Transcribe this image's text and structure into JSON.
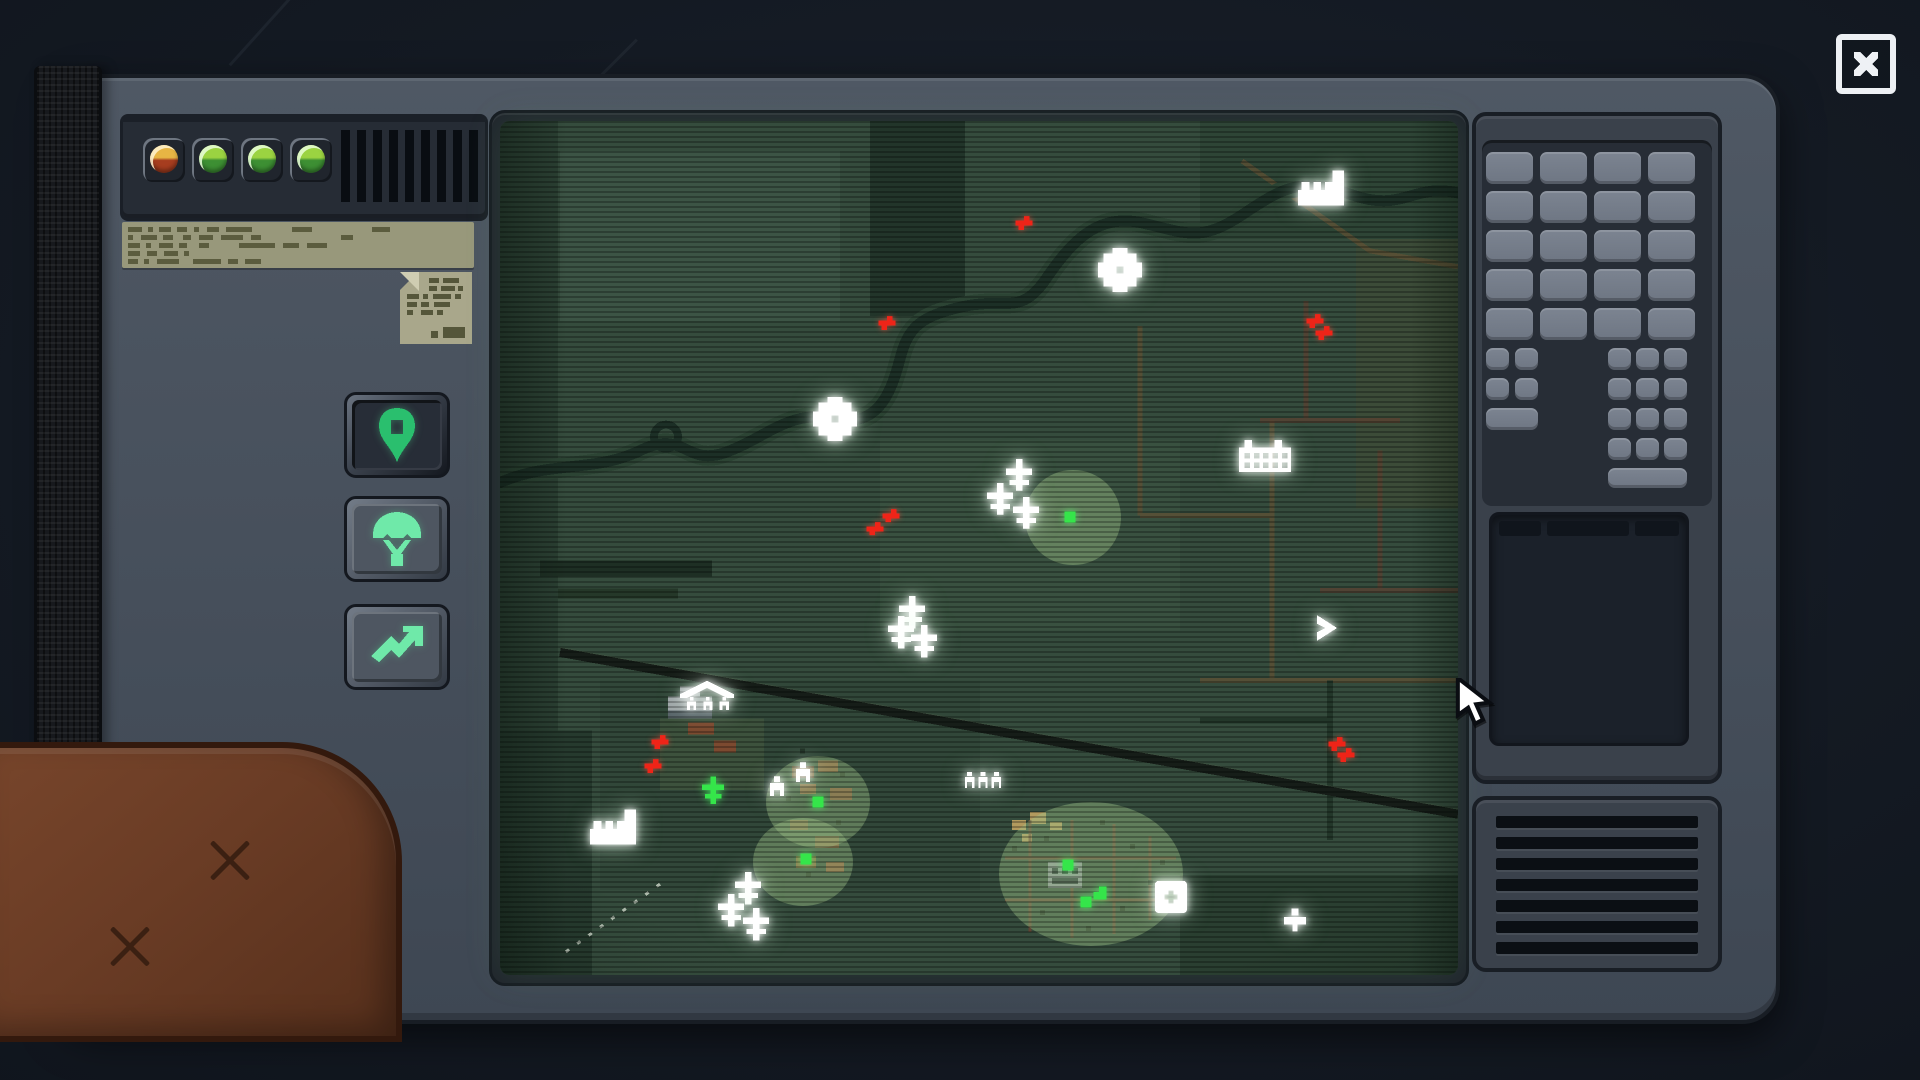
{
  "window": {
    "close_icon": "close-icon"
  },
  "device": {
    "status_leds": [
      {
        "color": "amber"
      },
      {
        "color": "green"
      },
      {
        "color": "green"
      },
      {
        "color": "green"
      }
    ],
    "barcode": {
      "bars": 9
    },
    "sticker": {
      "kind": "printed-label-illegible",
      "rows": [
        "14,6,5,6,12,6,10,7,5,8,12,7,26,40,20,60,18,0",
        "5,8,16,6,10,10,8,8,14,8,22,8,10,80,12,0",
        "12,6,5,8,14,6,8,12,10,30,36,8,16,8,20,0",
        "12,7,10,7,14,6,5,0",
        "10,6,5,8,22,14,28,7,10,7,16,0"
      ]
    },
    "paper_note": {
      "kind": "paper-note-illegible",
      "rows": [
        {
          "pad": 24,
          "p": "10,4,16,0"
        },
        {
          "pad": 24,
          "p": "8,4,14,3,5,0"
        },
        {
          "pad": 2,
          "p": "12,4,5,5,18,4,6,0"
        },
        {
          "pad": 2,
          "p": "10,4,8,5,16,0"
        },
        {
          "pad": 2,
          "p": "6,8,12,4,6,0"
        }
      ]
    },
    "side_buttons": [
      {
        "id": "waypoint",
        "icon": "map-pin-icon",
        "active": true
      },
      {
        "id": "paradrop",
        "icon": "parachute-icon",
        "active": false
      },
      {
        "id": "advance",
        "icon": "trend-up-icon",
        "active": false
      }
    ]
  },
  "map": {
    "screen_color": "#354c3d",
    "zone_color": "#a0c387",
    "zones": [
      {
        "x": 573,
        "y": 397,
        "rx": 48,
        "ry": 48
      },
      {
        "x": 318,
        "y": 682,
        "rx": 52,
        "ry": 46
      },
      {
        "x": 303,
        "y": 742,
        "rx": 50,
        "ry": 44
      },
      {
        "x": 591,
        "y": 754,
        "rx": 92,
        "ry": 72
      }
    ],
    "markers": [
      {
        "type": "factory",
        "x": 821,
        "y": 67
      },
      {
        "type": "gear",
        "x": 620,
        "y": 149
      },
      {
        "type": "gear",
        "x": 335,
        "y": 298
      },
      {
        "type": "barracks",
        "x": 765,
        "y": 334
      },
      {
        "type": "plane",
        "x": 519,
        "y": 354
      },
      {
        "type": "plane",
        "x": 500,
        "y": 378
      },
      {
        "type": "plane",
        "x": 526,
        "y": 392
      },
      {
        "type": "plane",
        "x": 412,
        "y": 492
      },
      {
        "type": "plane",
        "x": 401,
        "y": 512
      },
      {
        "type": "plane",
        "x": 424,
        "y": 521
      },
      {
        "type": "tent",
        "x": 207,
        "y": 578
      },
      {
        "type": "soldier",
        "x": 277,
        "y": 666
      },
      {
        "type": "soldier",
        "x": 303,
        "y": 652
      },
      {
        "type": "persons",
        "x": 483,
        "y": 660
      },
      {
        "type": "factory",
        "x": 113,
        "y": 707
      },
      {
        "type": "plane",
        "x": 248,
        "y": 768
      },
      {
        "type": "plane",
        "x": 231,
        "y": 790
      },
      {
        "type": "plane",
        "x": 256,
        "y": 804
      },
      {
        "type": "crate",
        "x": 671,
        "y": 777
      },
      {
        "type": "club",
        "x": 795,
        "y": 800
      },
      {
        "type": "chevron",
        "x": 827,
        "y": 508
      },
      {
        "type": "red",
        "x": 524,
        "y": 102
      },
      {
        "type": "red",
        "x": 387,
        "y": 202
      },
      {
        "type": "red",
        "x": 815,
        "y": 200
      },
      {
        "type": "red",
        "x": 824,
        "y": 212
      },
      {
        "type": "red",
        "x": 391,
        "y": 395
      },
      {
        "type": "red",
        "x": 375,
        "y": 408
      },
      {
        "type": "red",
        "x": 160,
        "y": 622
      },
      {
        "type": "red",
        "x": 153,
        "y": 646
      },
      {
        "type": "red",
        "x": 837,
        "y": 624
      },
      {
        "type": "red",
        "x": 846,
        "y": 635
      },
      {
        "type": "green",
        "x": 570,
        "y": 396
      },
      {
        "type": "green-plane",
        "x": 213,
        "y": 670
      },
      {
        "type": "green",
        "x": 318,
        "y": 682
      },
      {
        "type": "green",
        "x": 306,
        "y": 739
      },
      {
        "type": "green",
        "x": 568,
        "y": 745
      },
      {
        "type": "green",
        "x": 586,
        "y": 782
      },
      {
        "type": "green-angle",
        "x": 600,
        "y": 773
      }
    ]
  },
  "right_panel": {
    "keypad_large": {
      "cols": 4,
      "rows": 5
    },
    "keypad_small_left": {
      "cols": 2,
      "rows": 2,
      "wide_keys": 1
    },
    "keypad_small_right": {
      "cols": 3,
      "rows": 4,
      "wide_keys": 1
    },
    "display": {
      "header_segments": [
        44,
        86,
        46
      ]
    },
    "speaker": {
      "slats": 7
    }
  },
  "cursor": {
    "visible": true
  }
}
